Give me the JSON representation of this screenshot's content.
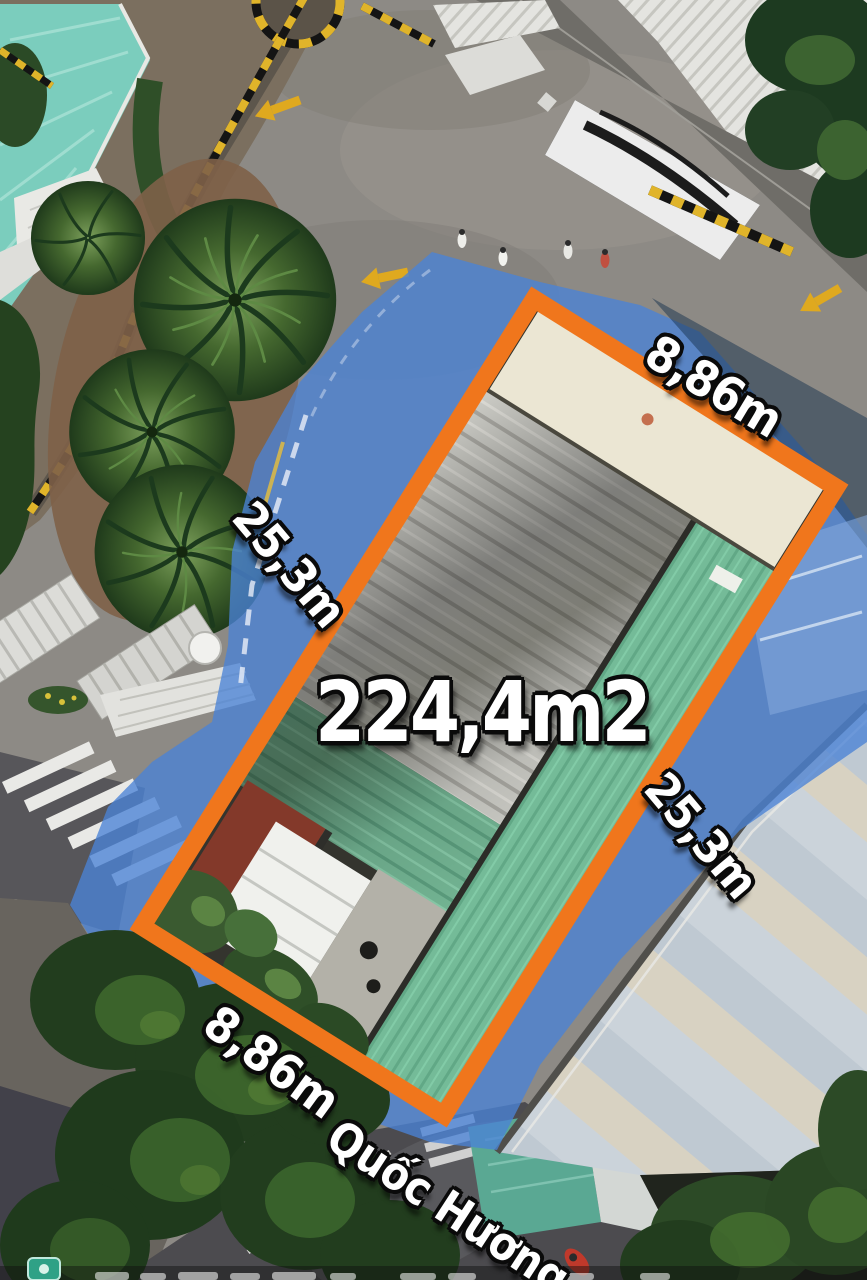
{
  "annotation": {
    "area_label": "224,4m2",
    "top_width_label": "8,86m",
    "bottom_width_label": "8,86m",
    "left_length_label": "25,3m",
    "right_length_label": "25,3m",
    "street_name": "Quốc Hương"
  },
  "colors": {
    "boundary_orange": "#f0761c",
    "highlight_blue": "#4b84d6",
    "label_fill": "#ffffff",
    "label_outline": "#0a0a0a",
    "watermark_badge": "#2fa186"
  },
  "icons": {
    "watermark": "photo-badge-icon"
  }
}
